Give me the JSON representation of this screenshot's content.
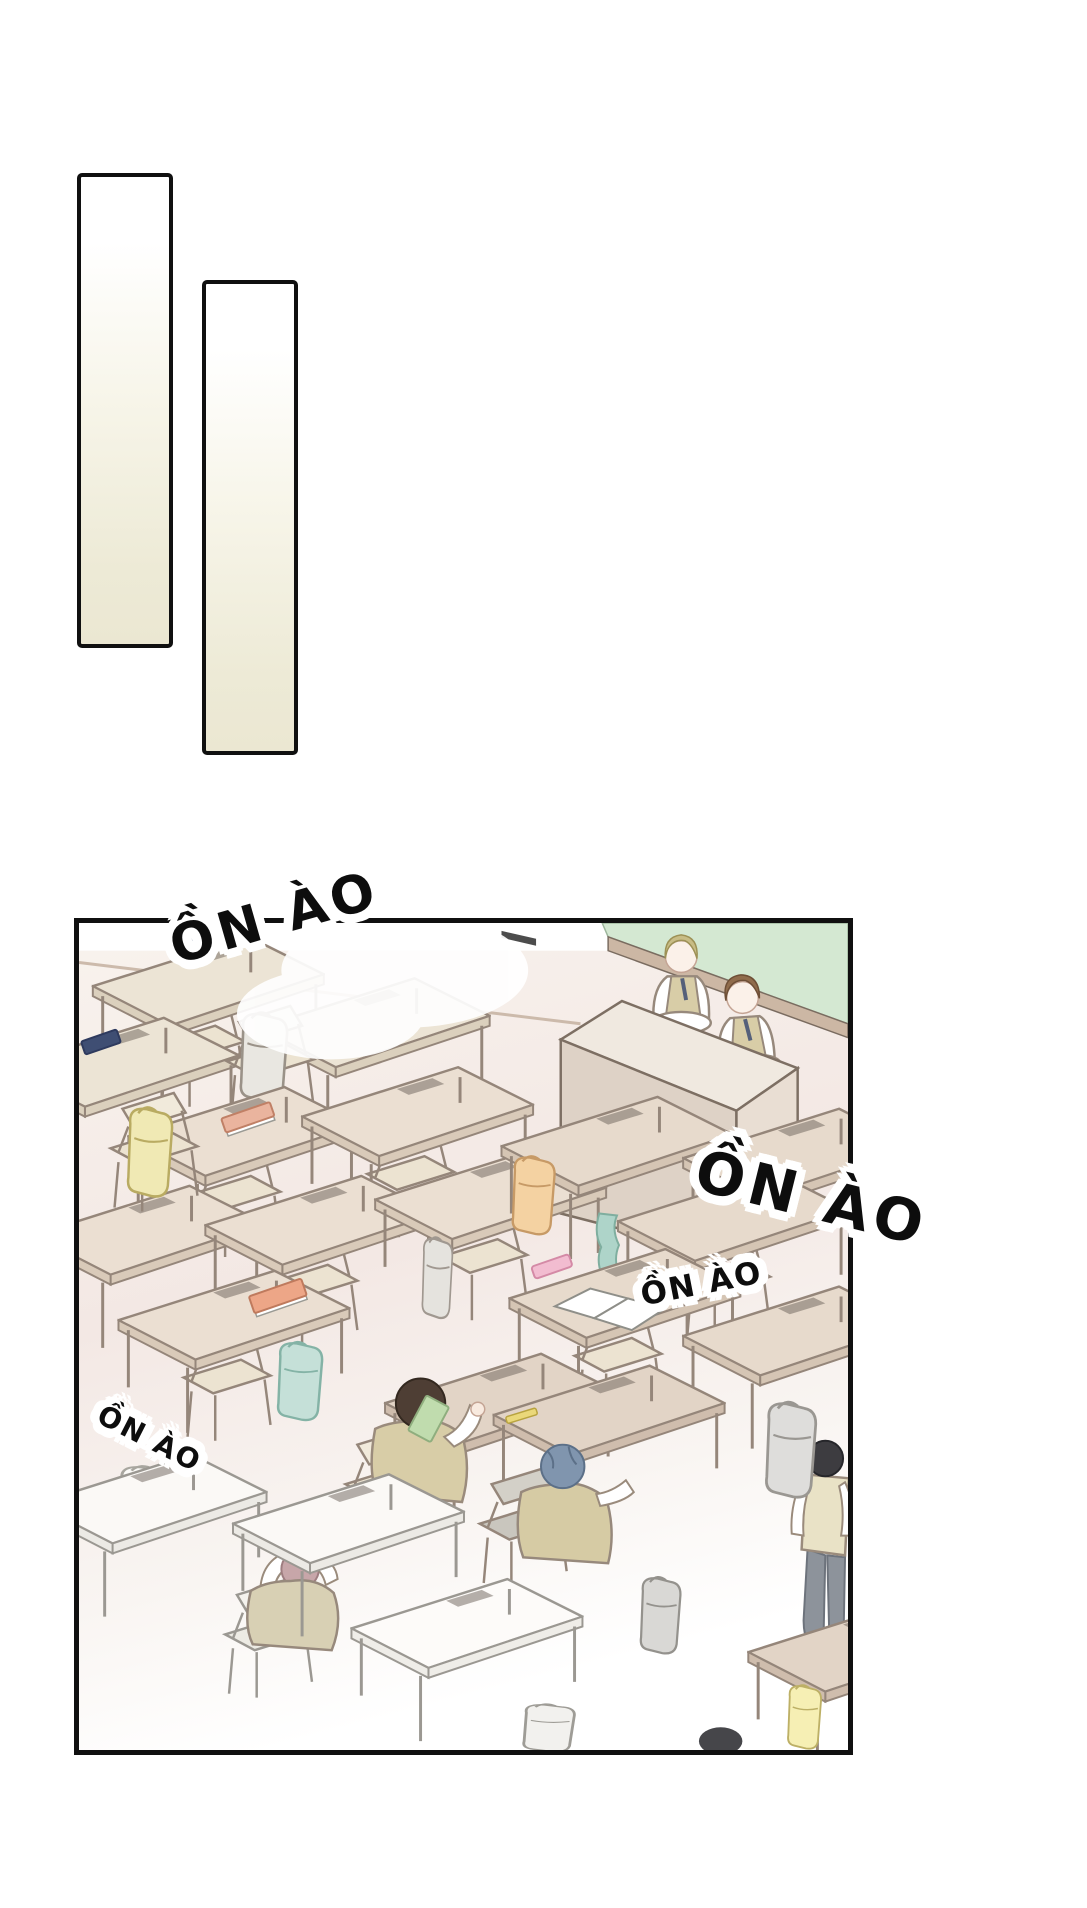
{
  "page": {
    "width": 1087,
    "height": 1908,
    "background": "#ffffff"
  },
  "sfx": [
    {
      "text": "ỒN ÀO"
    },
    {
      "text": "ỒN ÀO"
    },
    {
      "text": "ỒN ÀO"
    },
    {
      "text": "ỒN ÀO"
    }
  ],
  "colors": {
    "panel_border": "#101010",
    "bar_gradient_top": "#ffffff",
    "bar_gradient_bottom": "#edead6",
    "sfx_text": "#0d0d0d",
    "sfx_halo": "#ffffff",
    "chalkboard_green": "#d4e8d2",
    "chalkboard_frame": "#ccb7a4",
    "floor_pink": "#f3e8e4",
    "podium_front": "#ded2c6",
    "podium_top": "#f0e9e0",
    "desk_tan": "#ebdfd2",
    "desk_white": "#fbf9f6",
    "outline_brown": "#95867a",
    "vest_khaki": "#d8cda7",
    "hair_blonde": "#c8bc85",
    "hair_brown": "#906c4c",
    "hair_dark_brown": "#4e3e34",
    "hair_slate_blue": "#8095ae",
    "hair_mauve": "#c7a6a9",
    "hair_black": "#3d3c40",
    "bag_yellow": "#f0e9b4",
    "bag_orange": "#f4d2a2",
    "bag_mint": "#c5e0d8",
    "bag_grey": "#e5e3de",
    "book_blue": "#41507a",
    "book_salmon": "#eab49e",
    "book_orange": "#eda687",
    "book_green": "#c0dcae",
    "pencilcase_pink": "#f2bcd0",
    "pants_grey": "#8d939b",
    "shoe_red": "#c03a4a"
  }
}
